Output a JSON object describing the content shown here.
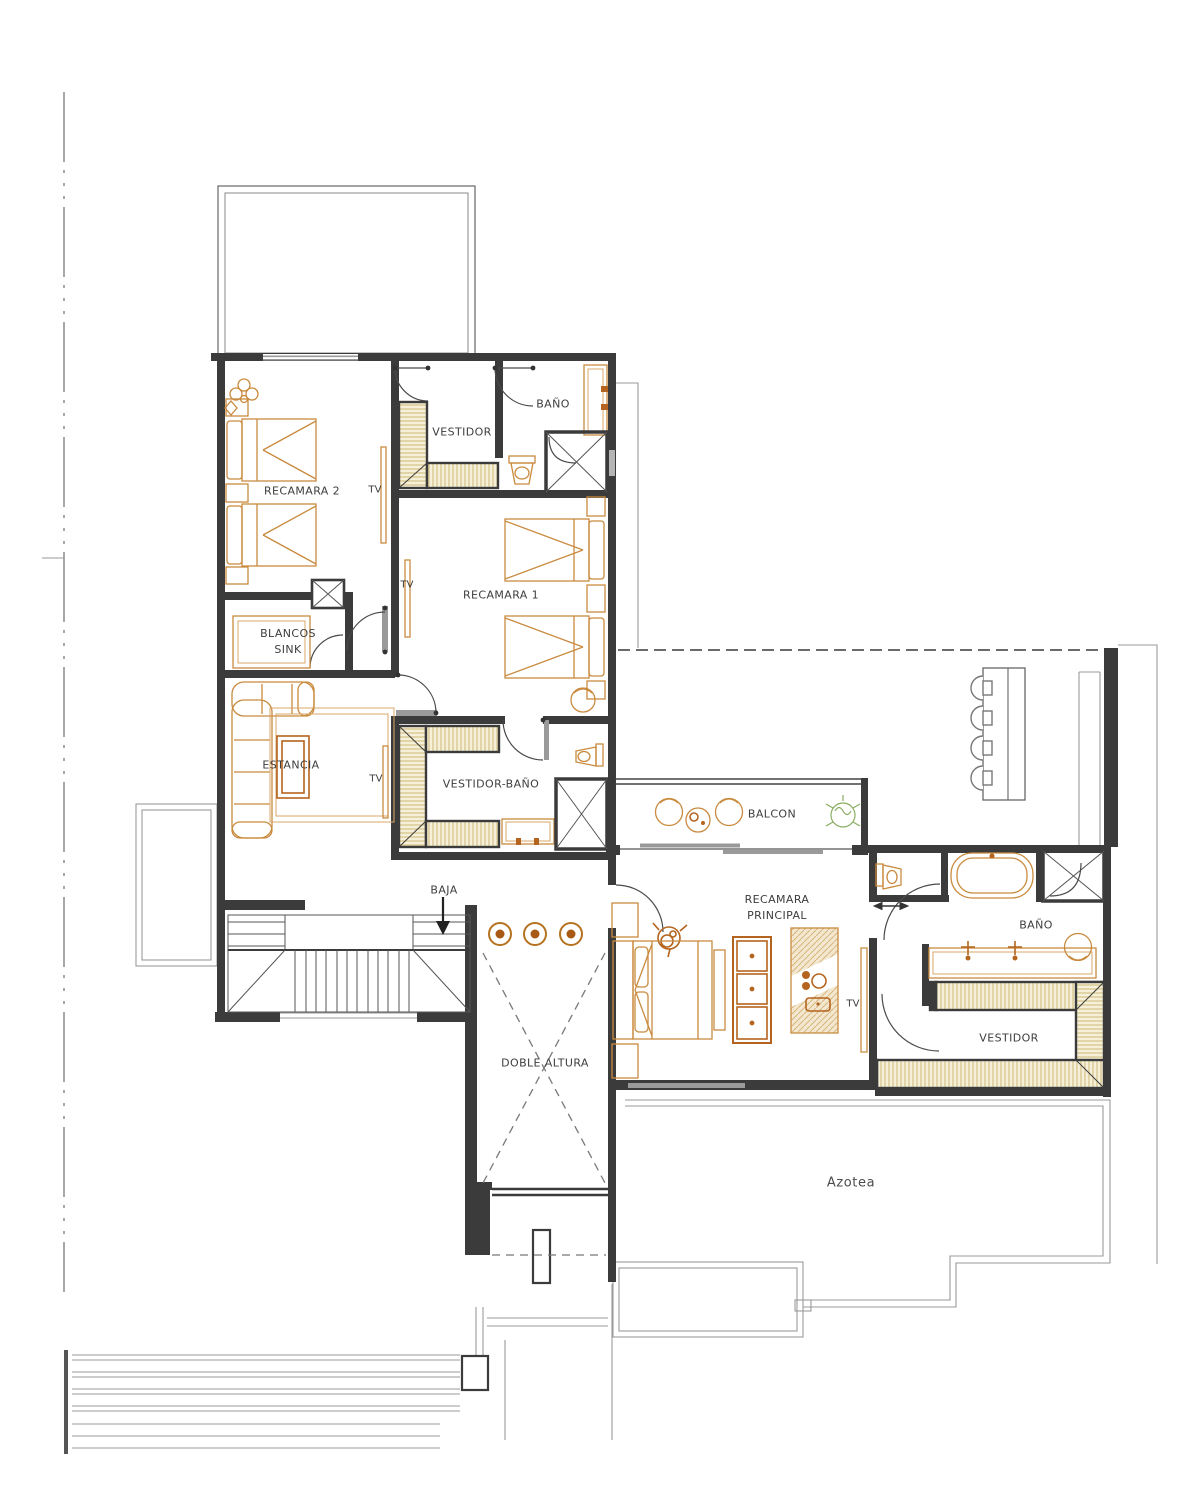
{
  "drawing": {
    "kind": "residential floor plan (upper level)",
    "language": "es"
  },
  "labels": {
    "recamara2": "RECAMARA 2",
    "vestidor_norte": "VESTIDOR",
    "bano_norte": "BAÑO",
    "tv": "TV",
    "recamara1": "RECAMARA 1",
    "blancos1": "BLANCOS",
    "blancos2": "SINK",
    "estancia": "ESTANCIA",
    "vestidor_bano": "VESTIDOR-BAÑO",
    "balcon": "BALCON",
    "recamara_principal1": "RECAMARA",
    "recamara_principal2": "PRINCIPAL",
    "baja": "BAJA",
    "doble_altura": "DOBLE ALTURA",
    "bano_principal": "BAÑO",
    "vestidor_principal": "VESTIDOR",
    "azotea": "Azotea"
  },
  "colors": {
    "wall": "#3b3b3b",
    "thin_line": "#555555",
    "ghost_line": "#9a9a9a",
    "furniture": "#c98a3e",
    "furniture_dark": "#b4641e",
    "closet_fill": "#f7f0d8",
    "closet_hatch": "#cbb878",
    "glass": "#9a9a9a",
    "plant": "#8aac62",
    "text": "#3d3d3d"
  },
  "icons": {
    "bed-icon": "rect with pillow strip and chevron fold",
    "toilet-icon": "tank plus trapezoid bowl with oval",
    "shower-icon": "square with X diagonals",
    "bathtub-icon": "double rounded rectangle",
    "sink-vanity-icon": "counter with faucet crosses",
    "closet-hatch-icon": "hatched wardrobe strip",
    "sofa-icon": "L-shaped rounded sectional",
    "tv-icon": "thin wall strip",
    "stairs-icon": "treads with break diagonals",
    "pendant-light-icon": "double circle with dot",
    "bar-stool-icon": "semicircle with seat square",
    "plant-icon": "scribbled circle with leaves",
    "down-arrow-icon": "vertical arrow head down",
    "door-swing-icon": "quarter arc with leaf"
  }
}
